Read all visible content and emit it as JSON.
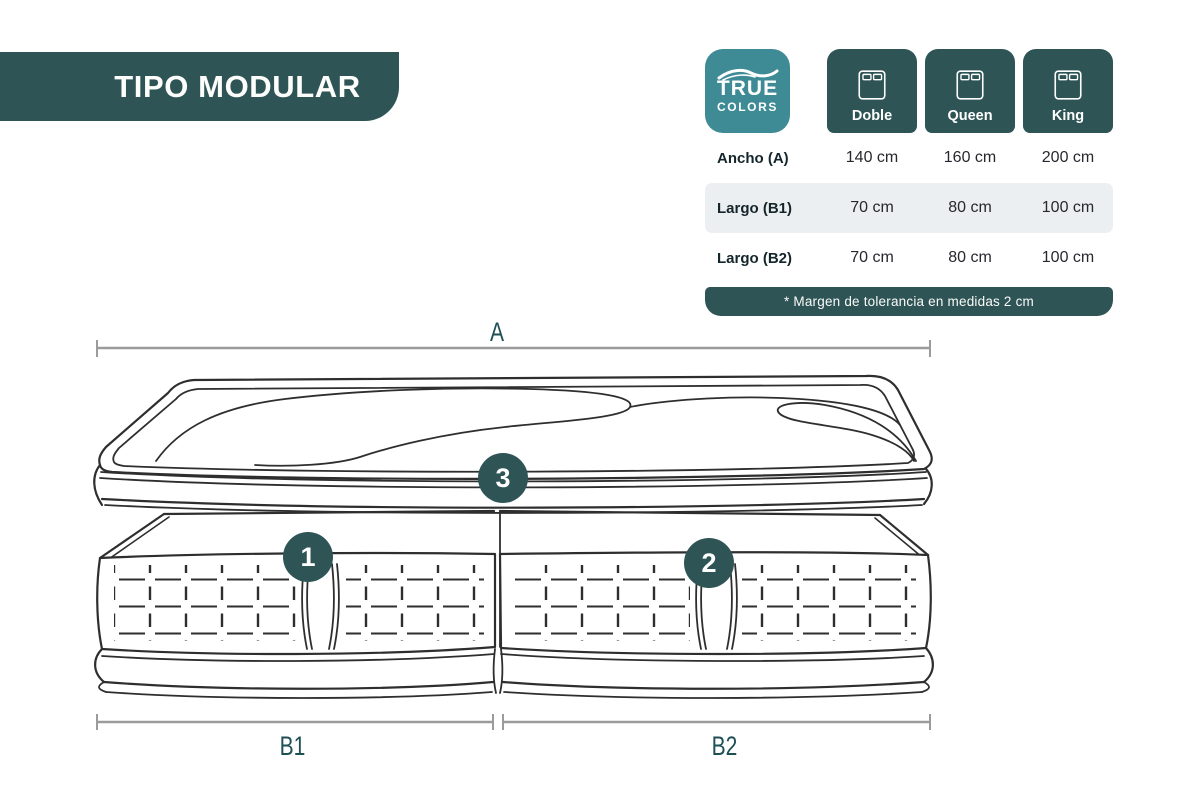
{
  "banner": {
    "title": "TIPO MODULAR"
  },
  "logo": {
    "line1": "TRUE",
    "line2": "COLORS"
  },
  "size_table": {
    "columns": [
      {
        "label": "Doble"
      },
      {
        "label": "Queen"
      },
      {
        "label": "King"
      }
    ],
    "rows": [
      {
        "label": "Ancho (A)",
        "values": [
          "140 cm",
          "160 cm",
          "200 cm"
        ]
      },
      {
        "label": "Largo (B1)",
        "values": [
          "70 cm",
          "80 cm",
          "100 cm"
        ]
      },
      {
        "label": "Largo (B2)",
        "values": [
          "70 cm",
          "80 cm",
          "100 cm"
        ]
      }
    ],
    "footnote": "* Margen de tolerancia en medidas 2 cm"
  },
  "diagram": {
    "top_dimension_label": "A",
    "bottom_left_dimension_label": "B1",
    "bottom_right_dimension_label": "B2",
    "badge_base_left": "1",
    "badge_base_right": "2",
    "badge_topper": "3"
  },
  "colors": {
    "teal_dark": "#2E5456",
    "teal_logo": "#3E8B96",
    "row_alt": "#ECEFF1",
    "dim_line_gray": "#9B9B9B",
    "label_teal": "#1D4F55",
    "drawing_stroke": "#2E2E2E"
  }
}
